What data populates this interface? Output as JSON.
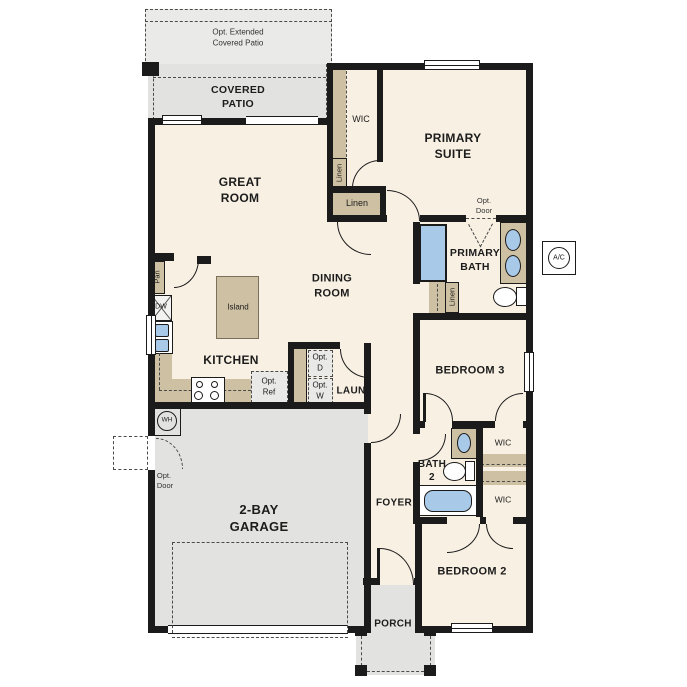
{
  "colors": {
    "wall": "#1b1b1b",
    "cream": "#f8f0e3",
    "gray": "#e2e2e0",
    "graylight": "#eaeae8",
    "tan": "#cec0a2",
    "blue": "#a9c9e8",
    "optfill": "#e9e9e7",
    "dash": "#4a4a4a"
  },
  "labels": {
    "opt_extended_patio": {
      "l1": "Opt. Extended",
      "l2": "Covered Patio"
    },
    "covered_patio": {
      "l1": "COVERED",
      "l2": "PATIO"
    },
    "great_room": {
      "l1": "GREAT",
      "l2": "ROOM"
    },
    "wic_primary": {
      "t": "WIC"
    },
    "primary_suite": {
      "l1": "PRIMARY",
      "l2": "SUITE"
    },
    "linen_wic": {
      "t": "Linen"
    },
    "linen_closet": {
      "t": "Linen"
    },
    "opt_door_primary": {
      "l1": "Opt.",
      "l2": "Door"
    },
    "primary_bath": {
      "l1": "PRIMARY",
      "l2": "BATH"
    },
    "linen_bath": {
      "t": "Linen"
    },
    "ac": {
      "t": "A/C"
    },
    "dining_room": {
      "l1": "DINING",
      "l2": "ROOM"
    },
    "island": {
      "t": "Island"
    },
    "kitchen": {
      "t": "KITCHEN"
    },
    "pantry": {
      "t": "Pan"
    },
    "dishwasher": {
      "t": "DW"
    },
    "opt_ref": {
      "l1": "Opt.",
      "l2": "Ref"
    },
    "opt_dryer": {
      "l1": "Opt.",
      "l2": "D"
    },
    "opt_washer": {
      "l1": "Opt.",
      "l2": "W"
    },
    "laundry": {
      "t": "LAUN"
    },
    "bedroom3": {
      "t": "BEDROOM 3"
    },
    "wic_bed3": {
      "t": "WIC"
    },
    "bath2": {
      "l1": "BATH",
      "l2": "2"
    },
    "wic_bed2": {
      "t": "WIC"
    },
    "water_heater": {
      "t": "WH"
    },
    "opt_door_garage": {
      "l1": "Opt.",
      "l2": "Door"
    },
    "garage": {
      "l1": "2-BAY",
      "l2": "GARAGE"
    },
    "foyer": {
      "t": "FOYER"
    },
    "bedroom2": {
      "t": "BEDROOM 2"
    },
    "porch": {
      "t": "PORCH"
    }
  }
}
